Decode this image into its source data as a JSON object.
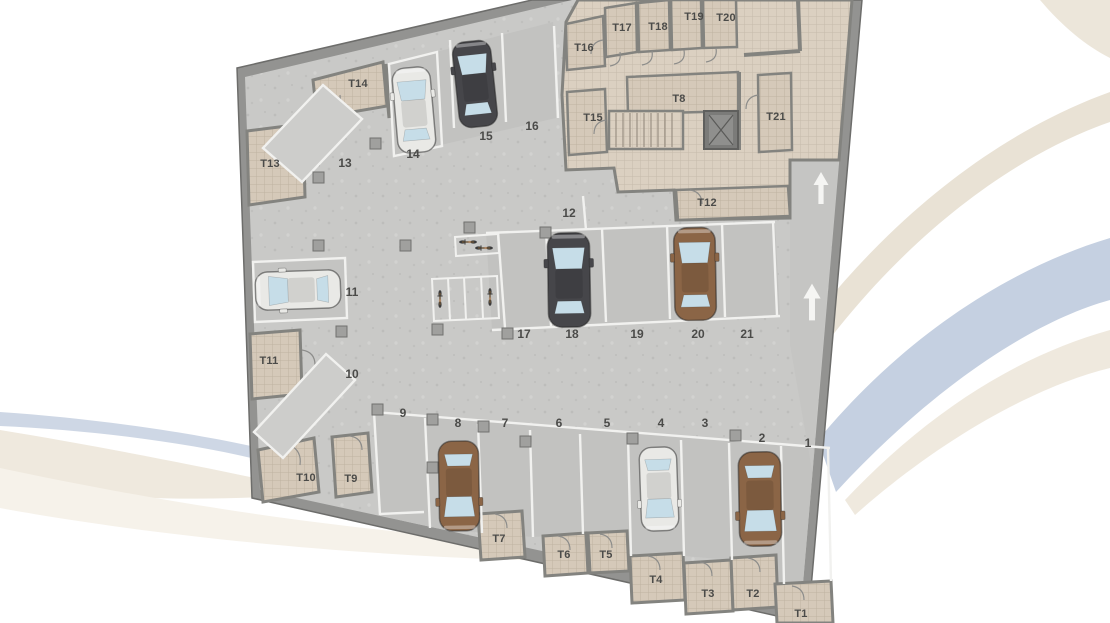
{
  "floor_plan": {
    "spots": [
      {
        "label": "1",
        "vehicle": "none"
      },
      {
        "label": "2",
        "vehicle": "brown-car"
      },
      {
        "label": "3",
        "vehicle": "none"
      },
      {
        "label": "4",
        "vehicle": "white-car"
      },
      {
        "label": "5",
        "vehicle": "none"
      },
      {
        "label": "6",
        "vehicle": "none"
      },
      {
        "label": "7",
        "vehicle": "none"
      },
      {
        "label": "8",
        "vehicle": "brown-car"
      },
      {
        "label": "9",
        "vehicle": "none"
      },
      {
        "label": "10",
        "vehicle": "none"
      },
      {
        "label": "11",
        "vehicle": "white-car"
      },
      {
        "label": "12",
        "vehicle": "none"
      },
      {
        "label": "13",
        "vehicle": "none"
      },
      {
        "label": "14",
        "vehicle": "white-car"
      },
      {
        "label": "15",
        "vehicle": "dark-car"
      },
      {
        "label": "16",
        "vehicle": "none"
      },
      {
        "label": "17",
        "vehicle": "none"
      },
      {
        "label": "18",
        "vehicle": "dark-car"
      },
      {
        "label": "19",
        "vehicle": "none"
      },
      {
        "label": "20",
        "vehicle": "brown-car"
      },
      {
        "label": "21",
        "vehicle": "none"
      }
    ],
    "storage_rooms": [
      {
        "label": "T1"
      },
      {
        "label": "T2"
      },
      {
        "label": "T3"
      },
      {
        "label": "T4"
      },
      {
        "label": "T5"
      },
      {
        "label": "T6"
      },
      {
        "label": "T7"
      },
      {
        "label": "T8"
      },
      {
        "label": "T9"
      },
      {
        "label": "T10"
      },
      {
        "label": "T11"
      },
      {
        "label": "T12"
      },
      {
        "label": "T13"
      },
      {
        "label": "T14"
      },
      {
        "label": "T15"
      },
      {
        "label": "T16"
      },
      {
        "label": "T17"
      },
      {
        "label": "T18"
      },
      {
        "label": "T19"
      },
      {
        "label": "T20"
      },
      {
        "label": "T21"
      }
    ],
    "features": {
      "ramp_arrows": "up-arrow",
      "elevator": "elevator",
      "stairs": "stairs",
      "bike_racks": "bicycle-parking"
    },
    "colors": {
      "floor": "#c9c9c7",
      "wall": "#939391",
      "room_tile": "#dbd0c1",
      "marking_line": "#f1f1ef",
      "car_white": "#e9e9e6",
      "car_dark": "#46464a",
      "car_brown": "#8b6546",
      "swoosh_blue": "#c5d0e1",
      "swoosh_beige": "#eae3d7"
    }
  }
}
